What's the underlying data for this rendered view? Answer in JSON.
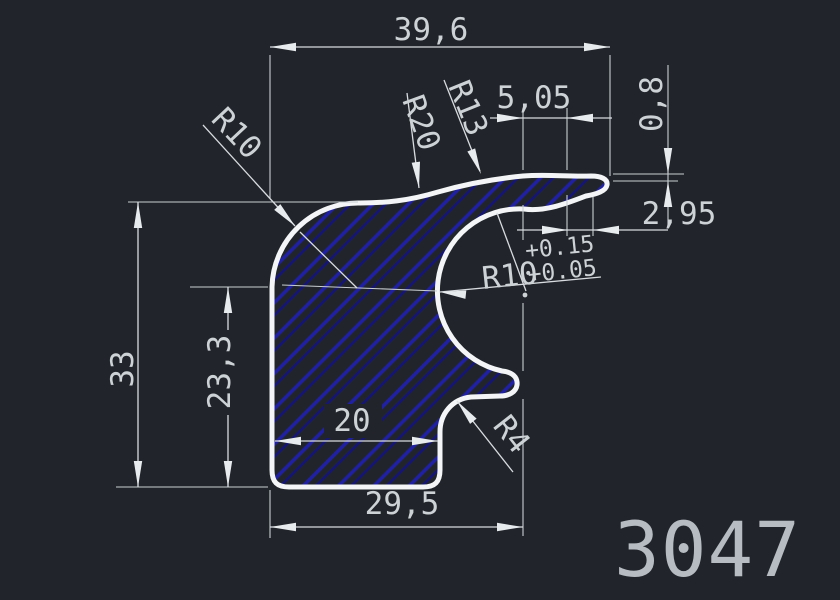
{
  "drawing_number": "3047",
  "colors": {
    "background": "#21252b",
    "outline": "#f3f5f6",
    "hatch_primary": "#2020a4",
    "hatch_secondary": "#14147a",
    "dimension_lines": "#d8dce0",
    "dimension_text": "#cdd2d6",
    "drawing_number_text": "#b6bcc2"
  },
  "dimensions": {
    "width_total": "39,6",
    "lip_segment": "5,05",
    "lip_thickness": "0,8",
    "tip_length": "2,95",
    "height_total": "33",
    "height_side": "23,3",
    "base_inner": "20",
    "base_width": "29,5"
  },
  "radii": {
    "corner_top_left": "R10",
    "top_arc": "R20",
    "lip_arc": "R13",
    "mouth": "R10",
    "mouth_tolerance_upper": "+0.15",
    "mouth_tolerance_lower": "+0.05",
    "fillet_bottom": "R4"
  }
}
